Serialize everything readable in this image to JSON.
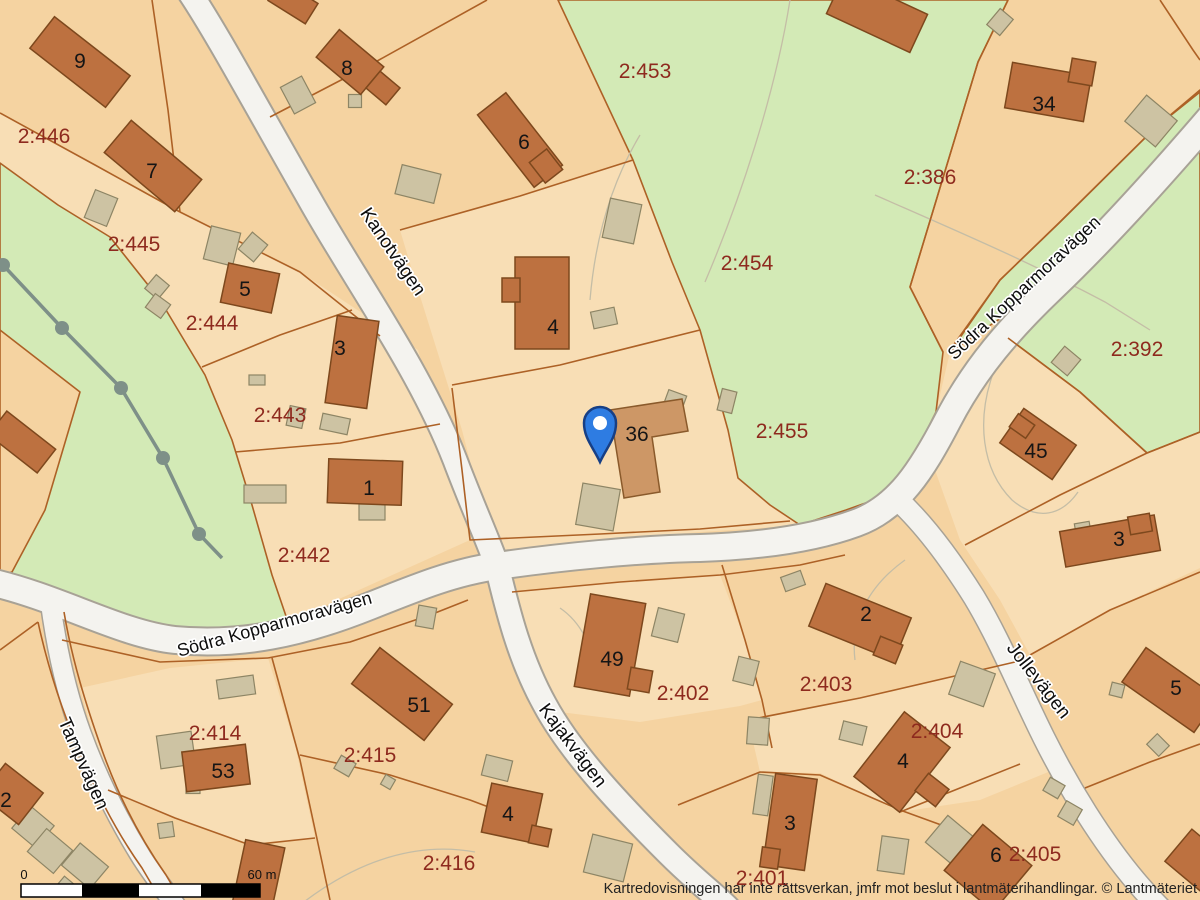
{
  "map": {
    "parcels": {
      "p446": "2:446",
      "p445": "2:445",
      "p444": "2:444",
      "p443": "2:443",
      "p442": "2:442",
      "p453": "2:453",
      "p454": "2:454",
      "p455": "2:455",
      "p386": "2:386",
      "p392": "2:392",
      "p414": "2:414",
      "p415": "2:415",
      "p416": "2:416",
      "p402": "2:402",
      "p403": "2:403",
      "p404": "2:404",
      "p401": "2:401",
      "p405": "2:405"
    },
    "houses": {
      "h9": "9",
      "h7": "7",
      "h5": "5",
      "h3a": "3",
      "h1": "1",
      "h8": "8",
      "h6": "6",
      "h4a": "4",
      "h36": "36",
      "h34": "34",
      "h45": "45",
      "h3b": "3",
      "h5b": "5",
      "h2a": "2",
      "h53": "53",
      "h51": "51",
      "h4b": "4",
      "h49": "49",
      "h2b": "2",
      "h4c": "4",
      "h3c": "3",
      "h6b": "6"
    },
    "roads": {
      "kanotvagen": "Kanotvägen",
      "sodra_sw": "Södra Kopparmoravägen",
      "sodra_ne": "Södra Kopparmoravägen",
      "kajakvagen": "Kajakvägen",
      "jollevagen": "Jollevägen",
      "tampvagen": "Tampvägen"
    },
    "scale": {
      "start": "0",
      "end": "60 m"
    },
    "attribution": "Kartredovisningen har inte rättsverkan, jmfr mot beslut i lantmäterihandlingar. © Lantmäteriet",
    "colors": {
      "parcel": "#f5d3a1",
      "parcel_light": "#f8deb5",
      "green": "#d3eab6",
      "road": "#f4f3ef",
      "boundary": "#ad6126",
      "building": "#bd7140",
      "outbuilding": "#cdc3a3",
      "parcel_text": "#8e2a1e",
      "pin": "#2e7ce2"
    }
  }
}
